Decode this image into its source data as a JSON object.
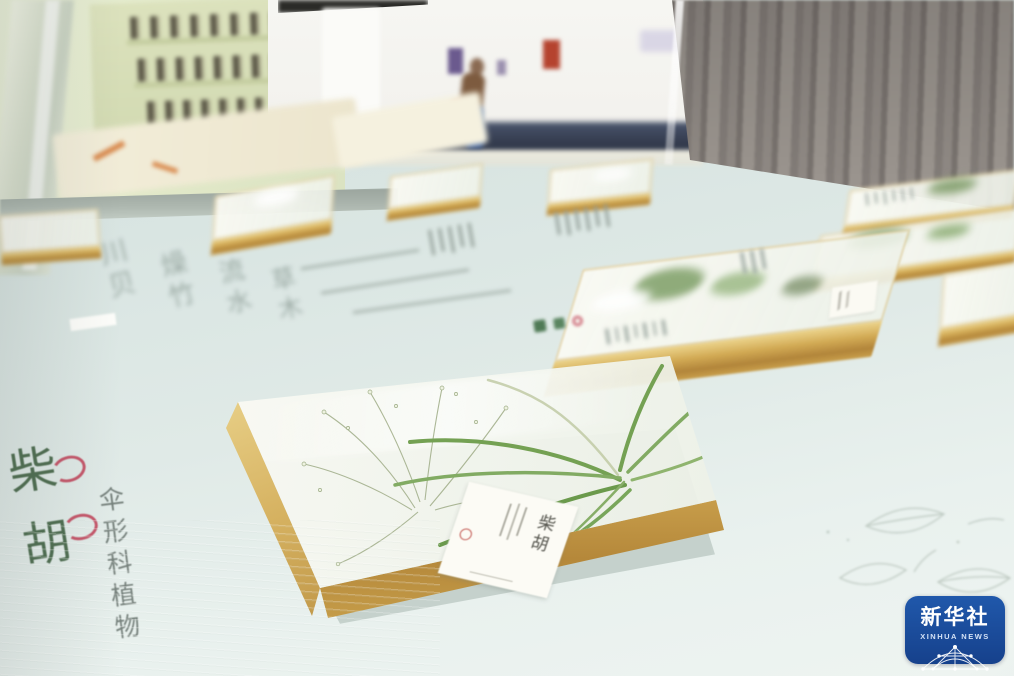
{
  "watermark": {
    "cn": "新华社",
    "en": "XINHUA NEWS"
  },
  "main_label": {
    "title_chars": [
      "柴",
      "胡"
    ],
    "family": "伞形科植物"
  },
  "specimen_tag": {
    "name": "柴胡"
  },
  "inscriptions": {
    "columns_approx": [
      "川贝",
      "燥竹",
      "流水",
      "草木"
    ]
  },
  "palette": {
    "table": "#dfe9e6",
    "resin_gold": "#c9a24b",
    "leaf_green": "#6f9c50",
    "title_green": "#4f6e51",
    "accent_red": "#c13e55",
    "watermark_blue": "#1a4b9b",
    "wood_gray": "#8d8782",
    "cabinet_green": "#d5dcb5",
    "floor_navy": "#3c4455"
  }
}
